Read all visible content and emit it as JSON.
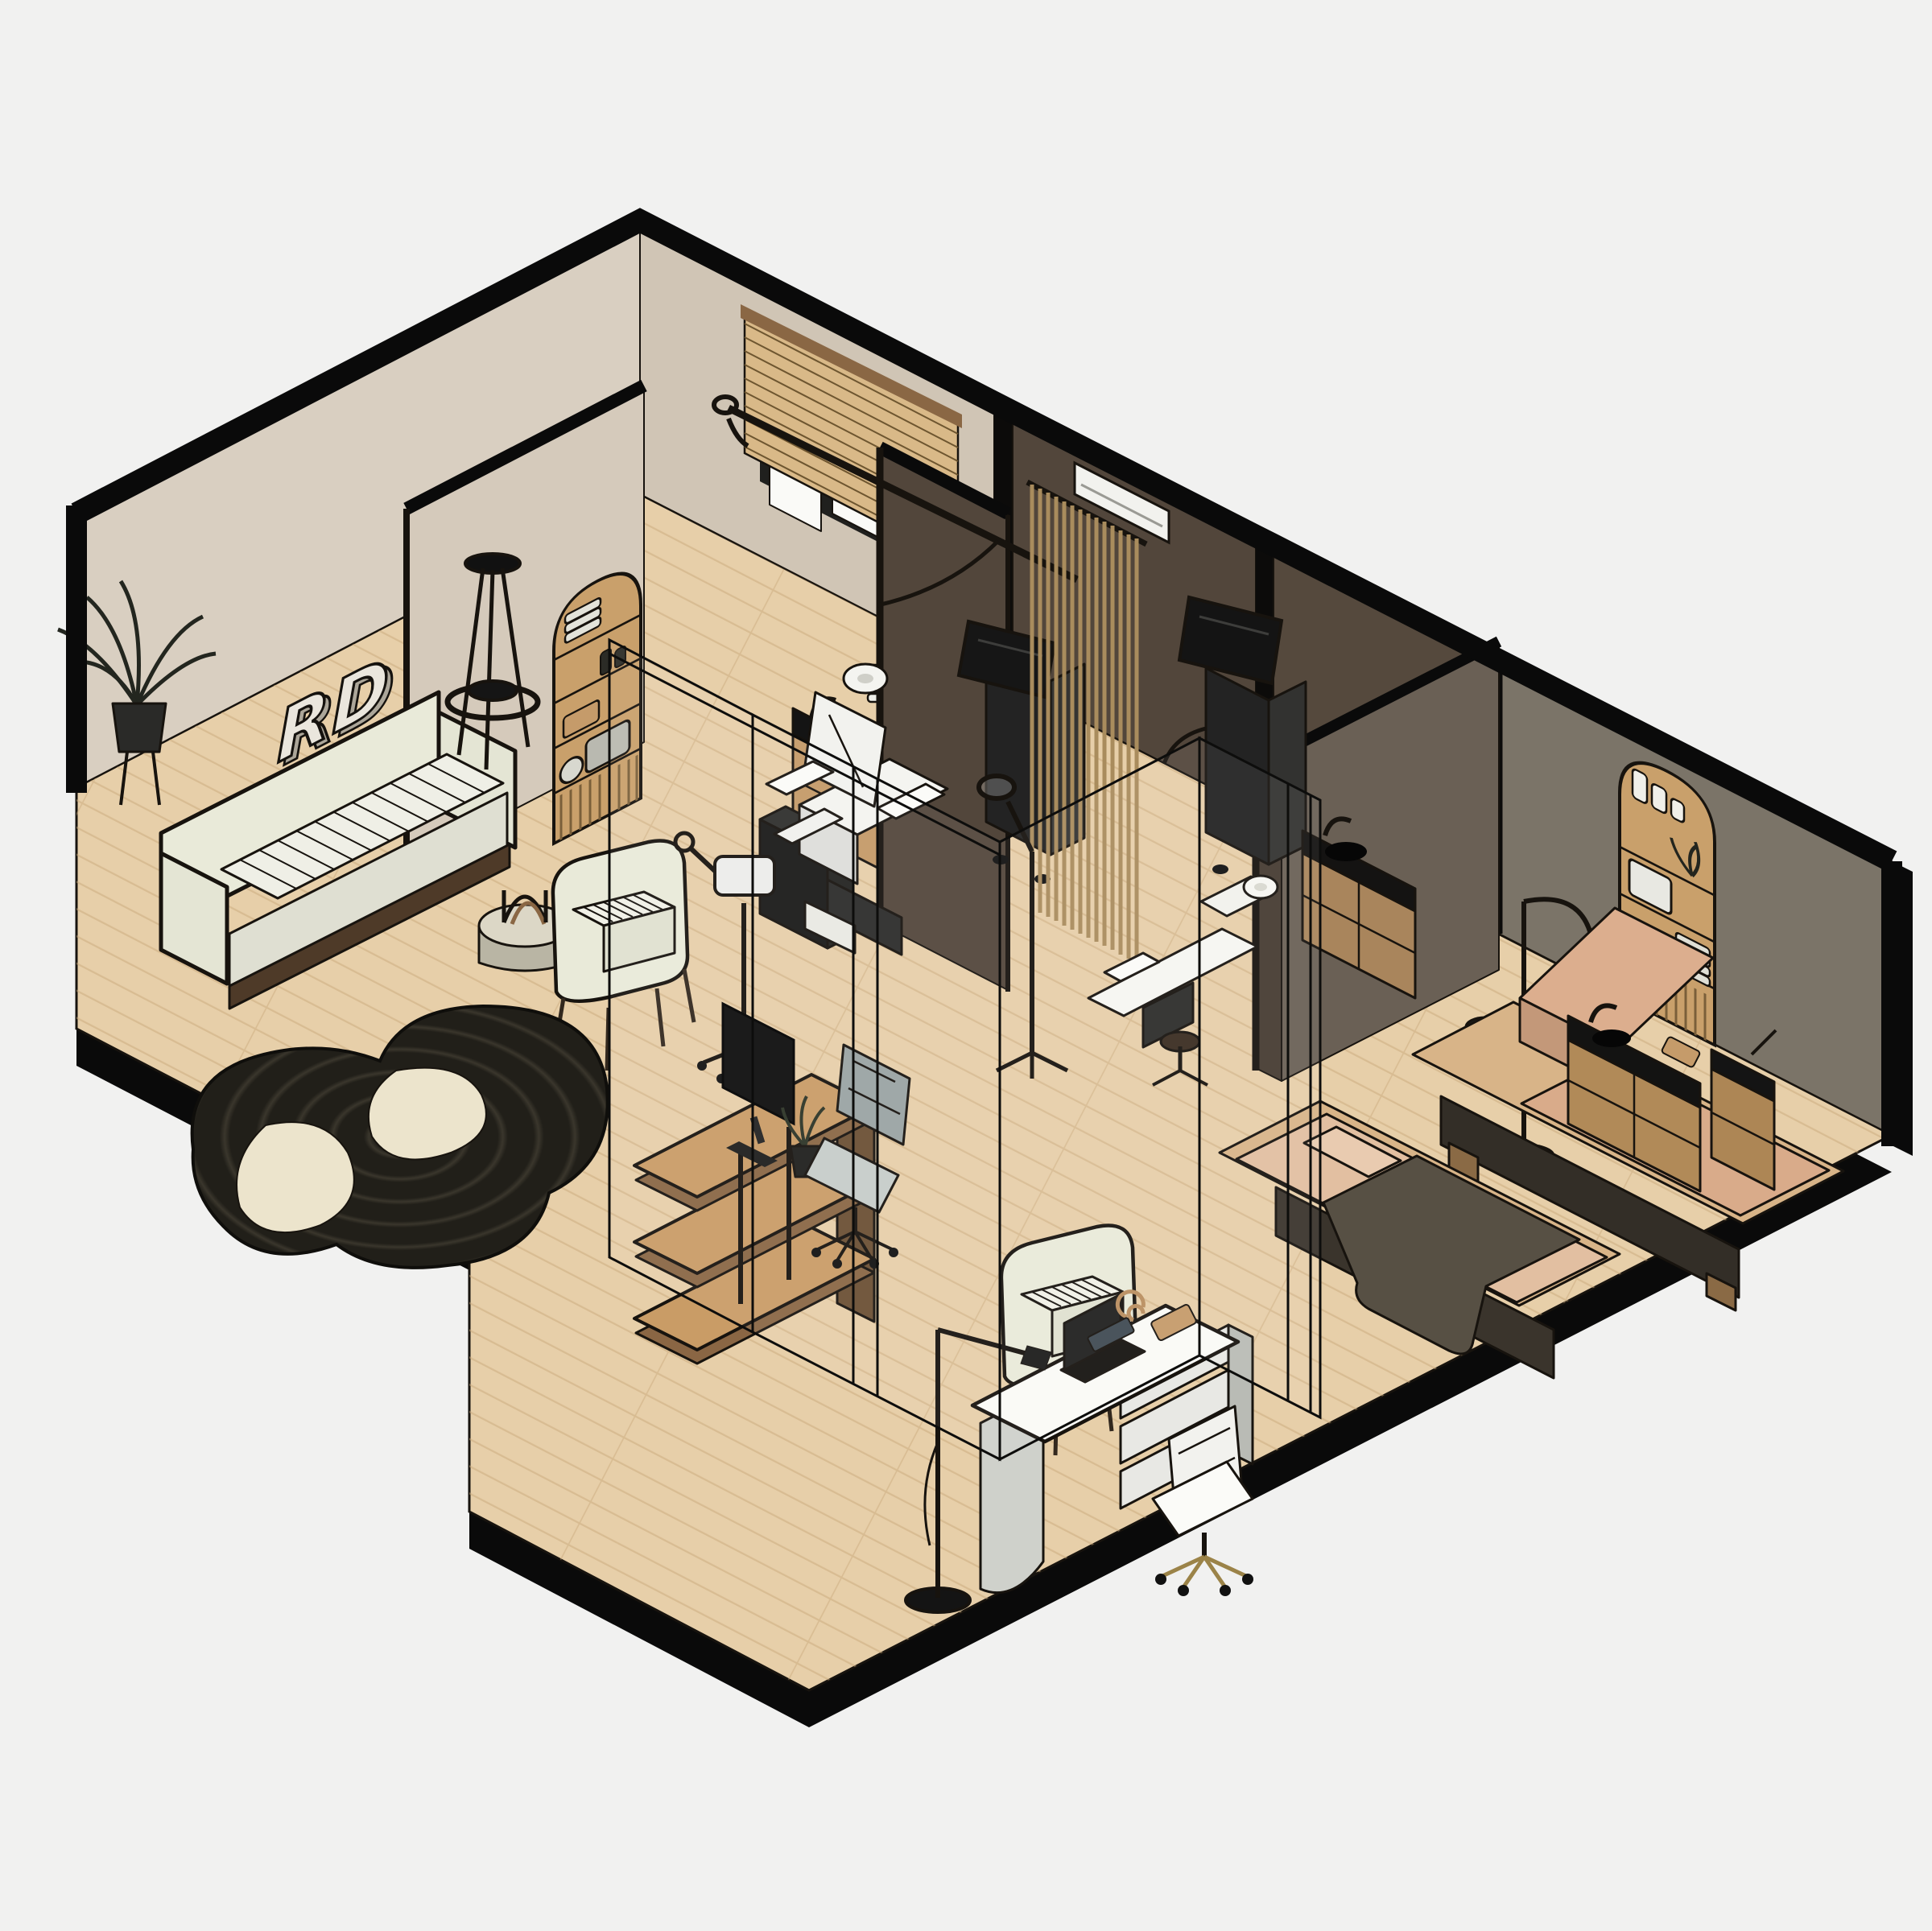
{
  "meta": {
    "title": "Isometric dermatology clinic floor plan render",
    "style": "isometric line-art 3D floor plan"
  },
  "logo": {
    "text": "RD"
  },
  "colors": {
    "background": "#f1f1f0",
    "outline": "#0a0a0a",
    "floor": "#e7cfa9",
    "plank": "#c9a87b",
    "wall_beige_light": "#d9cfc1",
    "wall_beige": "#d5cabb",
    "wall_beige_shaded": "#d0c5b5",
    "wall_dark_brown": "#52463b",
    "wall_brown_face": "#6a6055",
    "wall_gray": "#7b7468",
    "wood": "#c89a66",
    "wood_dark": "#8a6744",
    "black_furniture": "#1b1b1a",
    "white_furniture": "#f4f4f0",
    "cream": "#e9ead9",
    "tan": "#d9ab8a",
    "tan_light": "#e2bfa1",
    "blanket": "#575044",
    "rug_dark": "#211f19",
    "rug_cream": "#ece4cc",
    "glass_stroke": "#0d0d0c"
  },
  "scene": {
    "rooms": [
      {
        "name": "reception-lounge",
        "furniture": [
          "potted-plant",
          "ribbed-sofa",
          "tripod-floor-lamp",
          "wall-logo",
          "round-ottoman-with-magazines",
          "striped-armchair",
          "concentric-rug",
          "facial-steamer-trolley",
          "tiered-reception-desk",
          "desk-monitor",
          "desk-plant",
          "office-chair"
        ]
      },
      {
        "name": "treatment-room-1",
        "furniture": [
          "arched-shelf-niche",
          "window-with-wood-blinds",
          "sink-credenza",
          "towel-stacks",
          "sterilizer-box",
          "black-speaker",
          "laser-machine-with-boom-arm",
          "wood-slat-curtain",
          "ac-unit",
          "treatment-chair"
        ]
      },
      {
        "name": "treatment-room-2",
        "furniture": [
          "laser-machine-2",
          "sink-cabinet",
          "magnifier-lamp",
          "reclined-exam-chair",
          "rolling-stool"
        ]
      },
      {
        "name": "massage-room",
        "furniture": [
          "arched-shelf-niche-2",
          "arc-floor-lamp",
          "black-stool",
          "massage-bed-raised",
          "massage-bed-flat-with-blanket",
          "sink-cabinet-2",
          "tall-side-cabinet",
          "floor-lamp"
        ]
      },
      {
        "name": "consultation-area",
        "furniture": [
          "striped-armchair-2",
          "white-consult-desk",
          "laptop",
          "tissue-box",
          "desk-sculpture",
          "white-office-chair",
          "task-floor-lamp",
          "glass-partitions"
        ]
      }
    ]
  }
}
